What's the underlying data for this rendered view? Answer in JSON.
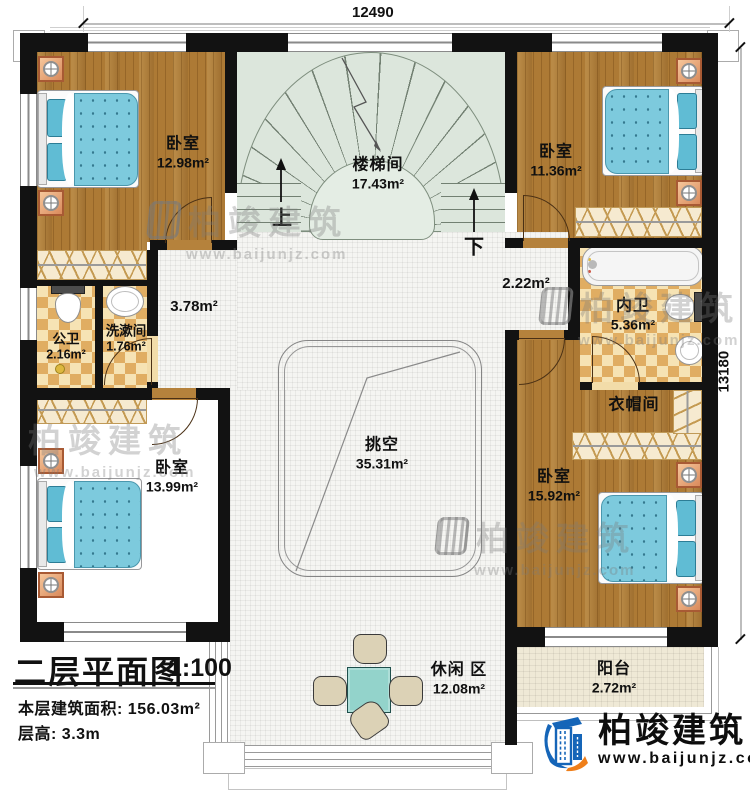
{
  "dimensions": {
    "top": "12490",
    "right": "13180"
  },
  "rooms": {
    "bedroom_tl": {
      "name": "卧室",
      "area": "12.98m²"
    },
    "stairwell": {
      "name": "楼梯间",
      "area": "17.43m²"
    },
    "bedroom_tr": {
      "name": "卧室",
      "area": "11.36m²"
    },
    "hall_left": {
      "area": "3.78m²"
    },
    "hall_right": {
      "area": "2.22m²"
    },
    "bath_public": {
      "name": "公卫",
      "area": "2.16m²"
    },
    "washroom": {
      "name": "洗漱间",
      "area": "1.76m²"
    },
    "bath_private": {
      "name": "内卫",
      "area": "5.36m²"
    },
    "cloakroom": {
      "name": "衣帽间"
    },
    "void": {
      "name": "挑空",
      "area": "35.31m²"
    },
    "bedroom_bl": {
      "name": "卧室",
      "area": "13.99m²"
    },
    "bedroom_br": {
      "name": "卧室",
      "area": "15.92m²"
    },
    "leisure": {
      "name": "休闲 区",
      "area": "12.08m²"
    },
    "balcony": {
      "name": "阳台",
      "area": "2.72m²"
    }
  },
  "stairs": {
    "up": "上",
    "down": "下"
  },
  "title_block": {
    "title": "二层平面图",
    "scale": "1:100",
    "area_label": "本层建筑面积:",
    "area_value": "156.03m²",
    "height_label": "层高:",
    "height_value": "3.3m"
  },
  "brand": {
    "name": "柏竣建筑",
    "url": "www.baijunjz.com"
  },
  "watermark": {
    "name": "柏竣建筑",
    "url": "www.baijunjz.com"
  },
  "colors": {
    "wall": "#121212",
    "wood": "#ad7a35",
    "tile": "#f5f5f2",
    "stair": "#dce6dc",
    "checker": "#e0ad62",
    "bed": "#7dcadd",
    "logo_blue": "#1565b8",
    "logo_orange": "#ef7f1a"
  }
}
